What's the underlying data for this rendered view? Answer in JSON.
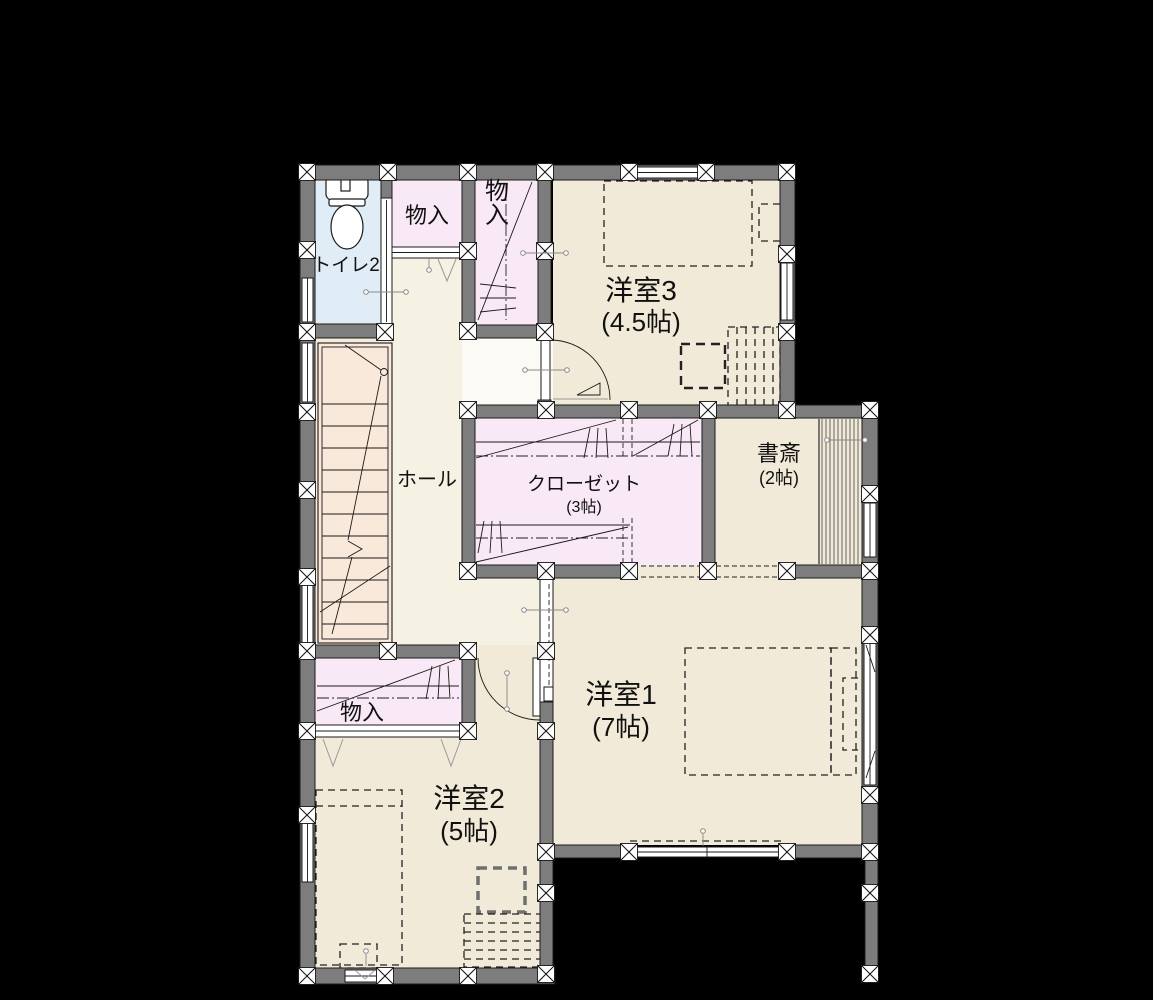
{
  "floorplan": {
    "background": "#000000",
    "colors": {
      "wall": "#7d7d7d",
      "outline": "#1a1a1a",
      "room_floor": "#f1ead8",
      "hall_floor": "#f5f1e3",
      "stairs_floor": "#f9e9da",
      "closet_floor": "#f9e9f6",
      "toilet_floor": "#e0edf6",
      "window": "#ffffff",
      "label": "#111111"
    },
    "rooms": [
      {
        "id": "toilet",
        "label": "トイレ2",
        "size": ""
      },
      {
        "id": "storage-upper",
        "label": "物入",
        "size": ""
      },
      {
        "id": "storage-tall",
        "label": "物入",
        "size": ""
      },
      {
        "id": "bedroom3",
        "label": "洋室3",
        "size": "(4.5帖)"
      },
      {
        "id": "hall",
        "label": "ホール",
        "size": ""
      },
      {
        "id": "closet",
        "label": "クローゼット",
        "size": "(3帖)"
      },
      {
        "id": "study",
        "label": "書斎",
        "size": "(2帖)"
      },
      {
        "id": "bedroom1",
        "label": "洋室1",
        "size": "(7帖)"
      },
      {
        "id": "storage-bedroom2",
        "label": "物入",
        "size": ""
      },
      {
        "id": "bedroom2",
        "label": "洋室2",
        "size": "(5帖)"
      }
    ]
  }
}
